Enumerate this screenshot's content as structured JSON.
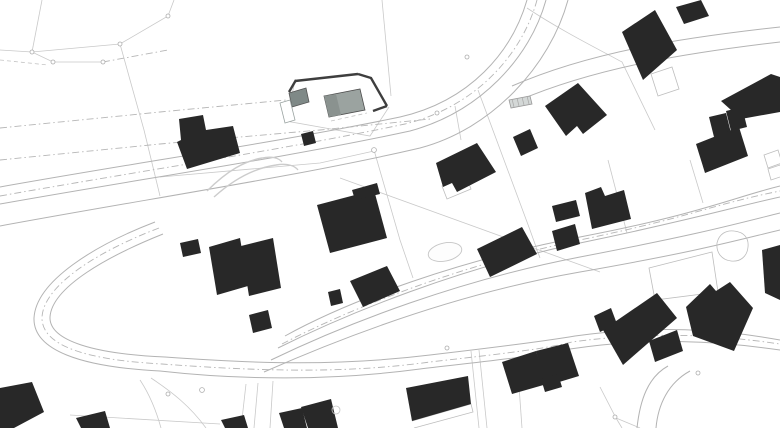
{
  "plan": {
    "width": 780,
    "height": 428,
    "background": "#ffffff",
    "colors": {
      "building_fill": "#282828",
      "site_building_fill": "#9ba3a0",
      "site_building_shade": "#8a928f",
      "site_garage_fill": "#7f8987",
      "site_boundary_stroke": "#3e3e3e",
      "road_stroke": "#b3b3b3",
      "parcel_stroke": "#c9c9c9",
      "dashdot_stroke": "#b6b6b6"
    },
    "layers": [
      {
        "name": "parcel-lines",
        "kind": "path",
        "stroke": "#c9c9c9",
        "width": 0.8,
        "fill": "none",
        "items": [
          {
            "d": "M42,0 L32,52"
          },
          {
            "d": "M0,50 L32,52 L53,62 L103,62"
          },
          {
            "d": "M32,52 L120,44 L168,16 L174,0"
          },
          {
            "d": "M120,44 L144,130 L160,196"
          },
          {
            "d": "M382,0 L391,96"
          },
          {
            "d": "M160,177 L320,163 L374,151"
          },
          {
            "d": "M374,150 L400,240 L413,278"
          },
          {
            "d": "M478,90 L530,230 L540,258"
          },
          {
            "d": "M340,178 L600,272"
          },
          {
            "d": "M527,8 C560,30 600,50 622,62 L655,130"
          },
          {
            "d": "M608,160 L627,233"
          },
          {
            "d": "M690,160 L703,203"
          },
          {
            "d": "M455,106 L461,140"
          },
          {
            "d": "M246,384 L241,428"
          },
          {
            "d": "M258,383 L254,428"
          },
          {
            "d": "M273,381 L270,428"
          },
          {
            "d": "M471,351 L479,428"
          },
          {
            "d": "M479,350 L487,428"
          },
          {
            "d": "M518,372 L522,428"
          },
          {
            "d": "M600,387 L616,418 L622,428"
          },
          {
            "d": "M616,418 L640,428"
          },
          {
            "d": "M140,380 C150,395 156,410 161,428"
          },
          {
            "d": "M151,378 C172,392 190,406 206,428"
          },
          {
            "d": "M70,415 L220,424"
          },
          {
            "d": "M295,81 L286,121 L370,136 L389,107"
          }
        ]
      },
      {
        "name": "dashed-parcel",
        "kind": "path",
        "stroke": "#c4c4c4",
        "width": 0.8,
        "dash": "4 3",
        "fill": "none",
        "items": [
          {
            "d": "M0,60 L48,65"
          },
          {
            "d": "M331,121 L367,113"
          }
        ]
      },
      {
        "name": "boundary-dashdot",
        "kind": "path",
        "stroke": "#b6b6b6",
        "width": 0.9,
        "dash": "7 3 1.5 3",
        "fill": "none",
        "items": [
          {
            "d": "M0,128 L160,112 L286,100"
          },
          {
            "d": "M0,160 L160,144 L320,130 L430,119"
          },
          {
            "d": "M103,62 L168,50"
          },
          {
            "d": "M0,196 C140,171 282,150 405,124 C475,107 522,55 537,0"
          },
          {
            "d": "M159,228 C101,250 44,284 42,317 C41,346 87,360 162,364 C270,372 350,373 430,362 C500,354 545,349 572,342 C653,331 719,335 780,344"
          },
          {
            "d": "M282,344 C355,306 465,264 580,240 S710,205 780,191"
          }
        ]
      },
      {
        "name": "road-edges",
        "kind": "path",
        "stroke": "#b3b3b3",
        "width": 1,
        "fill": "none",
        "items": [
          {
            "name": "road-upper-edge-1",
            "d": "M0,187 C140,162 280,142 400,117 C470,101 512,52 527,0"
          },
          {
            "name": "road-upper-edge-2",
            "d": "M0,204 C140,179 285,158 410,131 C480,112 530,58 546,0"
          },
          {
            "name": "road-upper-edge-3",
            "d": "M0,226 C140,200 300,176 420,148 C492,129 550,66 568,0"
          },
          {
            "name": "road-branch-ne-1",
            "d": "M512,86 C590,52 680,38 780,27"
          },
          {
            "name": "road-branch-ne-2",
            "d": "M520,100 C600,66 695,52 780,42"
          },
          {
            "name": "hairpin-outer",
            "d": "M155,222 C95,245 36,281 34,318 C33,350 80,367 160,371 C240,380 330,381 420,369 C480,362 530,357 570,349 C650,337 718,341 780,350"
          },
          {
            "name": "hairpin-inner",
            "d": "M163,234 C108,256 52,287 50,317 C49,341 95,354 165,357 C260,364 340,366 430,355 C490,348 540,342 575,336 C655,325 720,329 780,340"
          },
          {
            "name": "south-branch-1",
            "d": "M668,366 C648,377 640,400 637,428"
          },
          {
            "name": "south-branch-2",
            "d": "M690,371 C668,383 658,405 656,428"
          },
          {
            "name": "road-mid-edge-1",
            "d": "M285,336 C350,300 460,260 580,237 S735,197 780,186"
          },
          {
            "name": "road-mid-edge-2",
            "d": "M278,348 C350,312 460,268 580,243 S730,208 780,197"
          },
          {
            "name": "road-mid-edge-3",
            "d": "M271,360 C350,322 460,280 580,257 S732,225 780,213"
          },
          {
            "name": "road-mid-edge-4",
            "d": "M264,372 C350,334 460,293 580,272 S734,241 780,230"
          }
        ]
      },
      {
        "name": "driveway-curves",
        "kind": "path",
        "stroke": "#cccccc",
        "width": 1.4,
        "fill": "none",
        "items": [
          {
            "d": "M207,191 C228,170 245,161 262,158 C272,156 279,158 282,162"
          },
          {
            "d": "M214,197 C235,178 255,168 276,165 C288,163 295,166 298,170"
          }
        ]
      },
      {
        "name": "light-outlines",
        "kind": "path",
        "stroke": "#bdbdbd",
        "width": 0.8,
        "fill": "none",
        "items": [
          {
            "name": "parcel-outline-e",
            "d": "M649,268 L712,252 L718,292 L655,300 Z"
          },
          {
            "name": "terrace-outline",
            "d": "M412,421 L471,404 L473,412 L414,428"
          },
          {
            "name": "terrace-outline-2",
            "d": "M442,186 L466,176 L471,189 L447,199 Z"
          },
          {
            "name": "carport-outline-ne",
            "d": "M651,74 L672,67 L679,89 L658,96 Z"
          },
          {
            "name": "shed-outline-e1",
            "d": "M764,155 L778,150 L782,163 L768,168 Z"
          },
          {
            "name": "shed-outline-e2",
            "d": "M768,169 L780,165 L783,176 L771,180 Z"
          },
          {
            "name": "driveway-loop",
            "d": "M717,243 C719,234 726,230 734,231 C744,232 749,238 748,247 C747,257 740,262 731,261 C722,260 716,253 717,243 Z"
          }
        ]
      },
      {
        "name": "pond",
        "kind": "ellipse",
        "stroke": "#c5c5c5",
        "width": 0.9,
        "fill": "#fdfdfd",
        "items": [
          {
            "name": "pond-oval",
            "cx": 445,
            "cy": 252,
            "rx": 17,
            "ry": 9,
            "rot": -12
          }
        ]
      },
      {
        "name": "buildings",
        "kind": "polygon",
        "fill": "#282828",
        "items": [
          {
            "name": "building-ne-corner",
            "points": "676,7 701,0 709,16 684,24"
          },
          {
            "name": "building-ne-main",
            "points": "622,32 655,10 677,50 643,80"
          },
          {
            "name": "building-n-mid",
            "points": "545,106 578,83 607,115 583,134 577,126 566,136"
          },
          {
            "name": "building-n-small",
            "points": "513,137 530,129 538,148 521,156"
          },
          {
            "name": "building-center-big",
            "points": "436,163 477,143 496,172 457,192 452,183 443,187"
          },
          {
            "name": "building-w-large",
            "points": "179,119 203,115 206,130 233,126 240,153 187,169 177,142 181,140"
          },
          {
            "name": "building-w-shed",
            "points": "301,134 313,131 316,143 304,146"
          },
          {
            "name": "building-center-house",
            "points": "317,205 374,190 387,238 330,253"
          },
          {
            "name": "building-center-house-annex",
            "points": "352,190 377,183 380,194 355,200"
          },
          {
            "name": "building-mid-1",
            "points": "209,247 240,238 248,286 217,295"
          },
          {
            "name": "building-mid-2",
            "points": "241,246 273,238 281,288 249,296"
          },
          {
            "name": "building-mid-garage",
            "points": "180,243 198,239 201,253 183,257"
          },
          {
            "name": "building-mid-sq",
            "points": "249,315 268,310 272,328 253,333"
          },
          {
            "name": "building-c-garage",
            "points": "328,292 340,289 343,303 331,306"
          },
          {
            "name": "building-c-house",
            "points": "350,281 387,266 400,291 363,307"
          },
          {
            "name": "building-e-small-1",
            "points": "552,206 576,200 580,216 556,222"
          },
          {
            "name": "building-e-mid",
            "points": "585,193 601,187 605,196 624,190 631,219 592,229"
          },
          {
            "name": "building-e-small-2",
            "points": "552,231 575,224 580,244 557,251"
          },
          {
            "name": "building-c-east",
            "points": "477,249 522,227 537,254 490,277"
          },
          {
            "name": "building-ne-complex-1",
            "points": "721,101 771,74 780,77 780,112 741,119"
          },
          {
            "name": "building-ne-complex-2",
            "points": "726,111 742,107 747,127 731,131"
          },
          {
            "name": "building-ne-complex-3",
            "points": "709,117 726,113 731,133 714,137"
          },
          {
            "name": "building-ne-complex-4",
            "points": "696,144 739,127 748,156 705,173"
          },
          {
            "name": "building-e-edge",
            "points": "762,250 780,245 780,300 765,293"
          },
          {
            "name": "building-s-1",
            "points": "406,388 468,376 471,404 412,421"
          },
          {
            "name": "building-s-2a",
            "points": "502,362 536,351 547,384 512,394"
          },
          {
            "name": "building-s-2b",
            "points": "536,351 568,343 579,376 546,386"
          },
          {
            "name": "building-s-2c",
            "points": "541,379 558,374 562,387 545,392"
          },
          {
            "name": "building-s-3",
            "points": "603,330 657,293 677,318 623,365"
          },
          {
            "name": "building-s-3-annex",
            "points": "594,316 611,308 617,324 600,332"
          },
          {
            "name": "building-s-3-step",
            "points": "649,341 677,330 683,351 655,362"
          },
          {
            "name": "building-s-4",
            "points": "686,307 710,284 716,291 730,282 753,308 734,351 693,336"
          },
          {
            "name": "building-sw-corner",
            "points": "0,388 32,382 44,412 14,428 0,428"
          },
          {
            "name": "building-sw-2",
            "points": "76,418 105,411 110,428 81,428"
          },
          {
            "name": "building-sw-3",
            "points": "221,420 244,415 248,428 225,428"
          },
          {
            "name": "building-sc-1",
            "points": "279,413 302,408 307,428 284,428"
          },
          {
            "name": "building-sc-2",
            "points": "301,407 331,399 338,428 308,428"
          }
        ]
      },
      {
        "name": "site-parcel-boundary",
        "kind": "path",
        "stroke": "#3e3e3e",
        "width": 2.4,
        "fill": "none",
        "items": [
          {
            "name": "site-boundary-n",
            "d": "M295,81 L358,74"
          },
          {
            "name": "site-boundary-e",
            "d": "M358,74 L371,78 L387,106"
          },
          {
            "name": "site-boundary-se",
            "d": "M387,106 L373,111"
          },
          {
            "name": "site-boundary-w",
            "d": "M296,80 L289,92"
          }
        ]
      },
      {
        "name": "site-structures",
        "kind": "polygon",
        "fill": "#9ba3a0",
        "stroke": "#4d4d4d",
        "width": 0.8,
        "items": [
          {
            "name": "site-building",
            "points": "324,96 360,89 365,110 329,117"
          },
          {
            "name": "site-building-shade",
            "points": "324,96 336,94 341,115 329,117",
            "fill": "#8a928f",
            "stroke": "none"
          },
          {
            "name": "site-garage",
            "points": "289,93 306,88 309,102 292,107",
            "fill": "#7f8987",
            "stroke": "#555555"
          },
          {
            "name": "site-carport",
            "points": "280,103 290,100 295,120 285,123",
            "fill": "#ffffff",
            "stroke": "#9aa3a1"
          },
          {
            "name": "site-shed-hatched",
            "points": "509,100 530,96 532,104 511,108",
            "fill": "#d4d8d7",
            "stroke": "#999999"
          }
        ]
      },
      {
        "name": "shed-hatch-lines",
        "kind": "path",
        "stroke": "#a8a8a8",
        "width": 0.7,
        "fill": "none",
        "items": [
          {
            "d": "M512,99 L514,107"
          },
          {
            "d": "M517,98 L519,106"
          },
          {
            "d": "M522,97 L524,105"
          },
          {
            "d": "M527,96 L529,104"
          }
        ]
      },
      {
        "name": "survey-markers",
        "kind": "circle",
        "stroke": "#adadad",
        "width": 0.8,
        "fill": "#ffffff",
        "items": [
          {
            "cx": 32,
            "cy": 52,
            "r": 2
          },
          {
            "cx": 53,
            "cy": 62,
            "r": 2
          },
          {
            "cx": 103,
            "cy": 62,
            "r": 2
          },
          {
            "cx": 120,
            "cy": 44,
            "r": 2
          },
          {
            "cx": 168,
            "cy": 16,
            "r": 2
          },
          {
            "cx": 374,
            "cy": 150,
            "r": 2.4
          },
          {
            "cx": 447,
            "cy": 348,
            "r": 2
          },
          {
            "cx": 437,
            "cy": 113,
            "r": 2
          },
          {
            "cx": 467,
            "cy": 57,
            "r": 2
          },
          {
            "cx": 202,
            "cy": 390,
            "r": 2.4
          },
          {
            "cx": 168,
            "cy": 394,
            "r": 2
          },
          {
            "cx": 615,
            "cy": 417,
            "r": 2
          },
          {
            "cx": 698,
            "cy": 373,
            "r": 2
          },
          {
            "cx": 336,
            "cy": 410,
            "r": 4,
            "fill": "none",
            "stroke": "#c5c5c5"
          }
        ]
      }
    ]
  }
}
